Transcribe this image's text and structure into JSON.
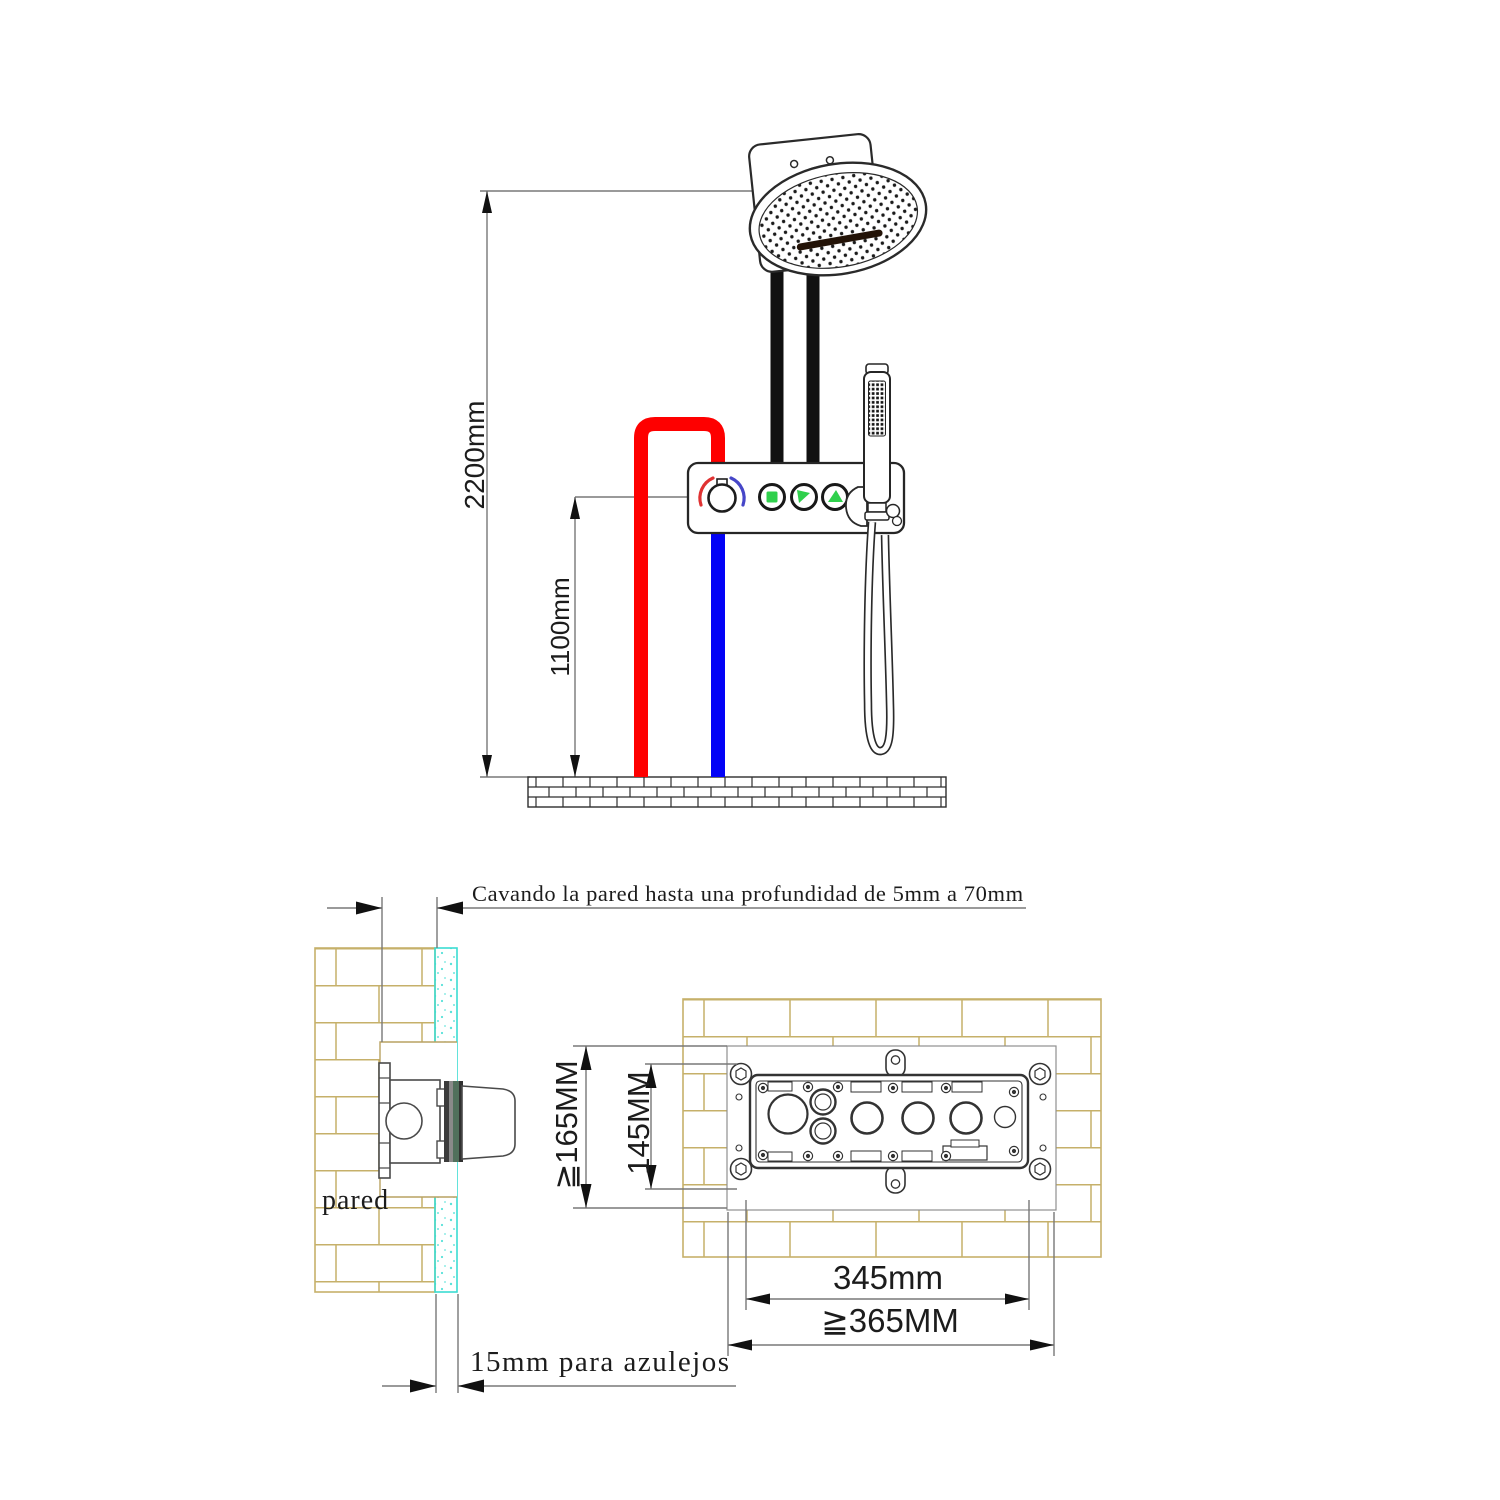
{
  "diagram_title": "shower-system-installation-diagram",
  "colors": {
    "hot_pipe": "#fe0000",
    "cold_pipe": "#0202f6",
    "black_pipe": "#111111",
    "brick_line": "#c6b06a",
    "tile_layer_line": "#3bdcd2",
    "button_green": "#2fd04c",
    "knob_hot_arc": "#e03232",
    "knob_cold_arc": "#4646c8",
    "dim_line": "#787878"
  },
  "top_view": {
    "dim_height_total": "2200mm",
    "dim_height_valve": "1100mm"
  },
  "installation_view": {
    "note_wall_depth": "Cavando la pared hasta una profundidad de 5mm a 70mm",
    "wall_label": "pared",
    "note_tile_allowance": "15mm para azulejos",
    "dim_recess_height": "≧165MM",
    "dim_box_height": "145MM",
    "dim_box_width": "345mm",
    "dim_recess_width": "≧365MM"
  }
}
